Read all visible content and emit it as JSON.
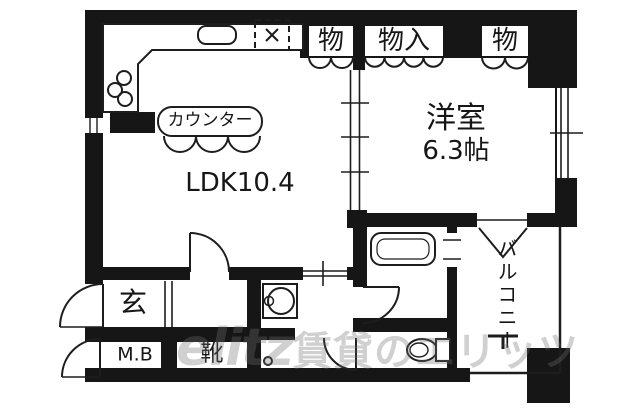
{
  "floorplan": {
    "rooms": {
      "ldk": {
        "label": "LDK10.4"
      },
      "western_room": {
        "name": "洋室",
        "size": "6.3帖"
      },
      "kitchen_counter": {
        "label": "カウンター"
      },
      "entrance": {
        "label": "玄"
      },
      "meter_box": {
        "label": "M.B"
      },
      "shoe_cabinet": {
        "label": "靴"
      },
      "balcony": {
        "label": "バルコニー"
      },
      "storage_left": {
        "label": "物"
      },
      "storage_center": {
        "label": "物入"
      },
      "storage_right": {
        "label": "物"
      }
    },
    "watermark": {
      "logo": "elitz",
      "text": "賃貸のエリッツ"
    },
    "colors": {
      "wall": "#161616",
      "line": "#1d1d1d",
      "text": "#161616",
      "watermark": "rgba(112,112,112,0.33)"
    }
  }
}
